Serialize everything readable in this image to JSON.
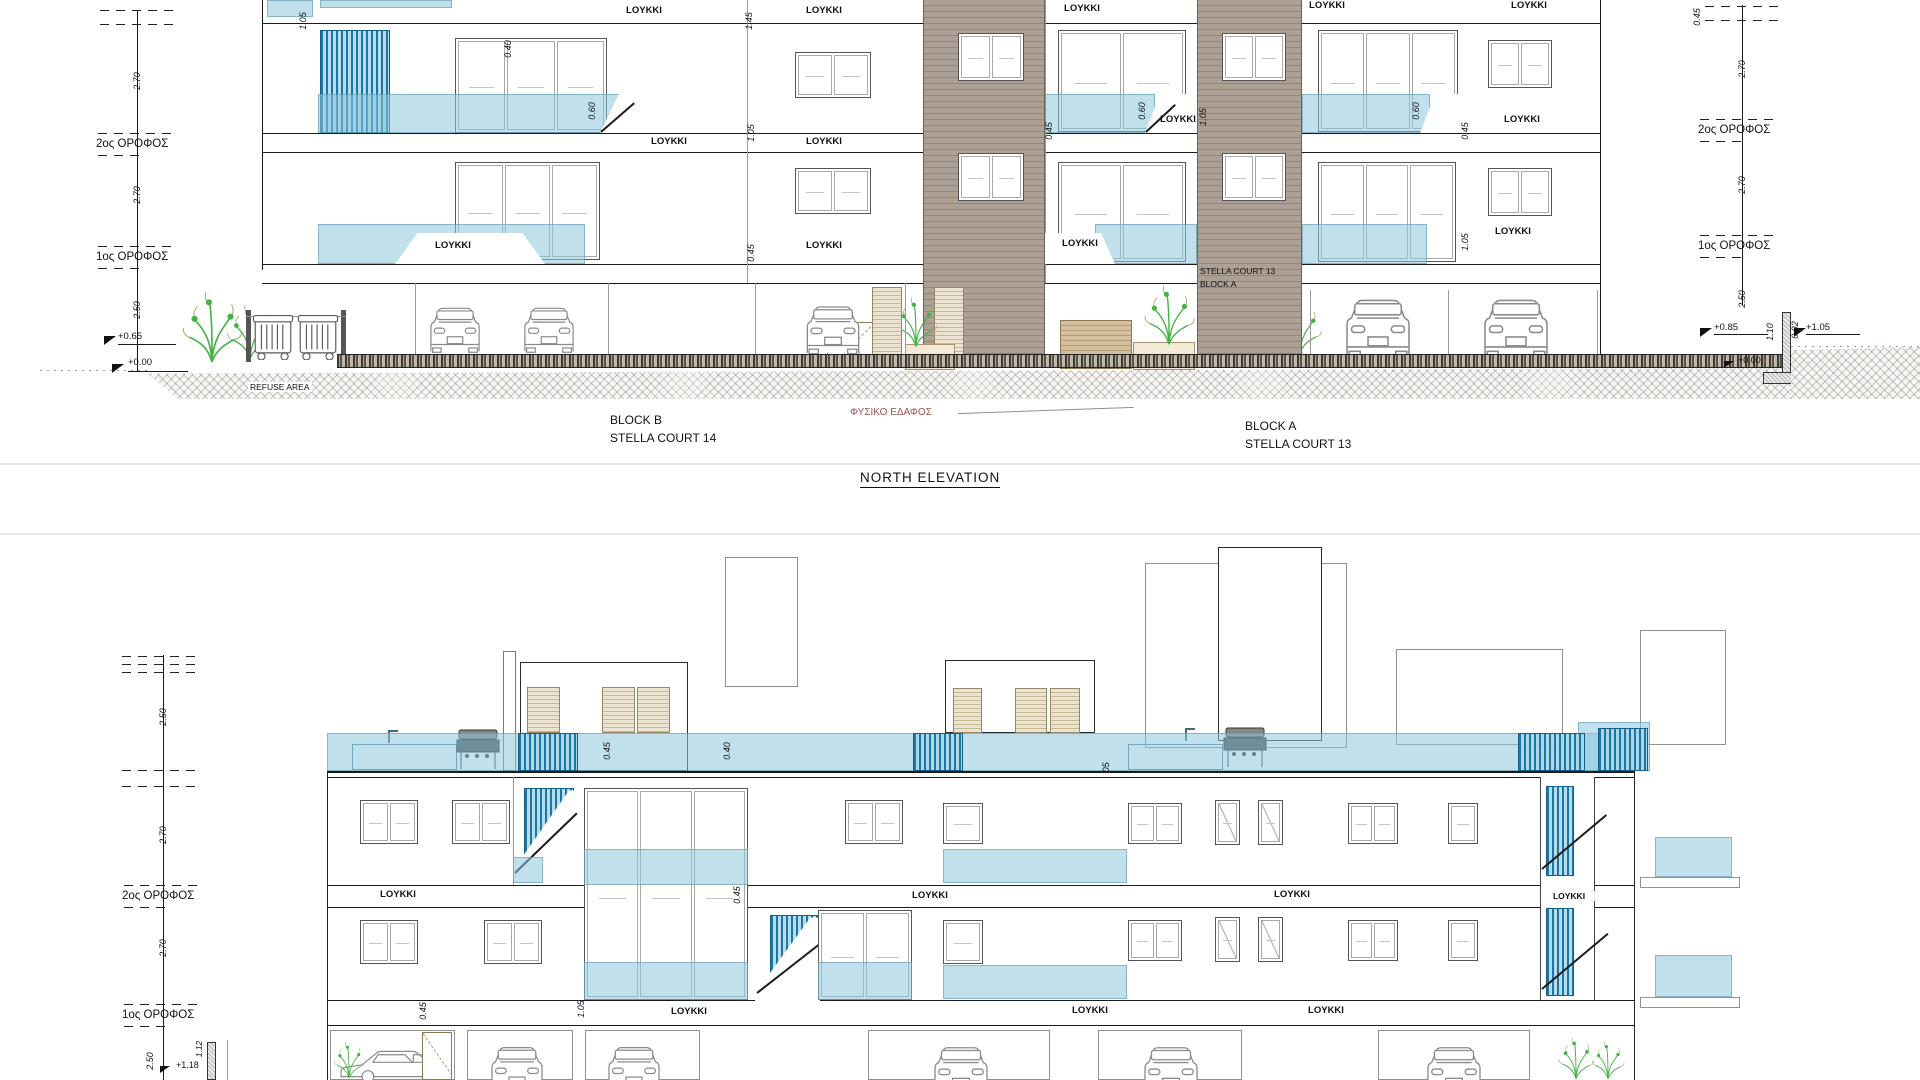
{
  "drawing": {
    "title": "NORTH ELEVATION",
    "blocks": {
      "left": {
        "name": "BLOCK B",
        "court": "STELLA COURT 14"
      },
      "right": {
        "name": "BLOCK A",
        "court": "STELLA COURT 13"
      }
    },
    "sign": {
      "line1": "STELLA COURT 13",
      "line2": "BLOCK A"
    },
    "labels": {
      "loykki": "LOYKKI",
      "refuse": "REFUSE AREA",
      "ground": "ΦΥΣΙΚΟ ΕΔΑΦΟΣ",
      "floor2": "2ος ΟΡΟΦΟΣ",
      "floor1": "1ος ΟΡΟΦΟΣ"
    },
    "dims": {
      "d040": "0.40",
      "d045": "0.45",
      "d060": "0.60",
      "d092": "0.92",
      "d105": "1.05",
      "d110": "1.10",
      "d112": "1.12",
      "d145": "1.45",
      "d250": "2.50",
      "d270": "2.70"
    },
    "levels": {
      "p000": "+0.00",
      "p065": "+0.65",
      "p085": "+0.85",
      "p105": "+1.05",
      "p118": "+1.18"
    },
    "colors": {
      "glass": "#b3d7e3",
      "railing": "#1f7aa8",
      "cladding": "#a89a8d",
      "shutter": "#e9e2cf",
      "plant": "#3cb83c",
      "ground_label": "#9c5050"
    }
  }
}
